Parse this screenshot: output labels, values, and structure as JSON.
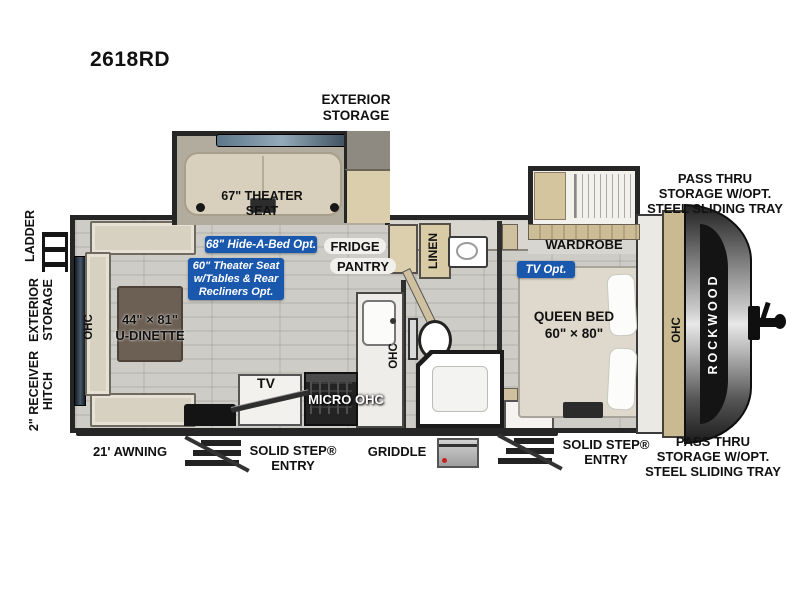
{
  "model": "2618RD",
  "colors": {
    "badge_blue": "#1a58ad",
    "wall": "#262626",
    "floor": "#c7c6c0",
    "furniture_beige": "#d8d0bc"
  },
  "exterior_labels": {
    "exterior_storage_top": "EXTERIOR\nSTORAGE",
    "pass_thru_front_top": "PASS THRU\nSTORAGE W/OPT.\nSTEEL SLIDING TRAY",
    "pass_thru_front_bottom": "PASS THRU\nSTORAGE W/OPT.\nSTEEL SLIDING TRAY",
    "ladder": "LADDER",
    "exterior_storage_rear": "EXTERIOR\nSTORAGE",
    "receiver_hitch": "2\" RECEIVER\nHITCH",
    "awning": "21' AWNING",
    "solid_step_main": "SOLID STEP®\nENTRY",
    "solid_step_bedroom": "SOLID STEP®\nENTRY",
    "griddle": "GRIDDLE"
  },
  "interior_labels": {
    "theater_seat": "67\" THEATER\nSEAT",
    "fridge": "FRIDGE",
    "pantry": "PANTRY",
    "linen": "LINEN",
    "wardrobe": "WARDROBE",
    "queen_bed": "QUEEN BED\n60\" × 80\"",
    "u_dinette": "44\" × 81\"\nU-DINETTE",
    "tv": "TV",
    "micro_ohc": "MICRO OHC",
    "ohc_rear": "OHC",
    "ohc_kitchen": "OHC",
    "ohc_front": "OHC",
    "brand": "ROCKWOOD"
  },
  "option_badges": {
    "hide_a_bed": "68\" Hide-A-Bed Opt.",
    "theater_seat_option": "60\" Theater Seat\nw/Tables & Rear\nRecliners Opt.",
    "tv_option": "TV Opt."
  }
}
